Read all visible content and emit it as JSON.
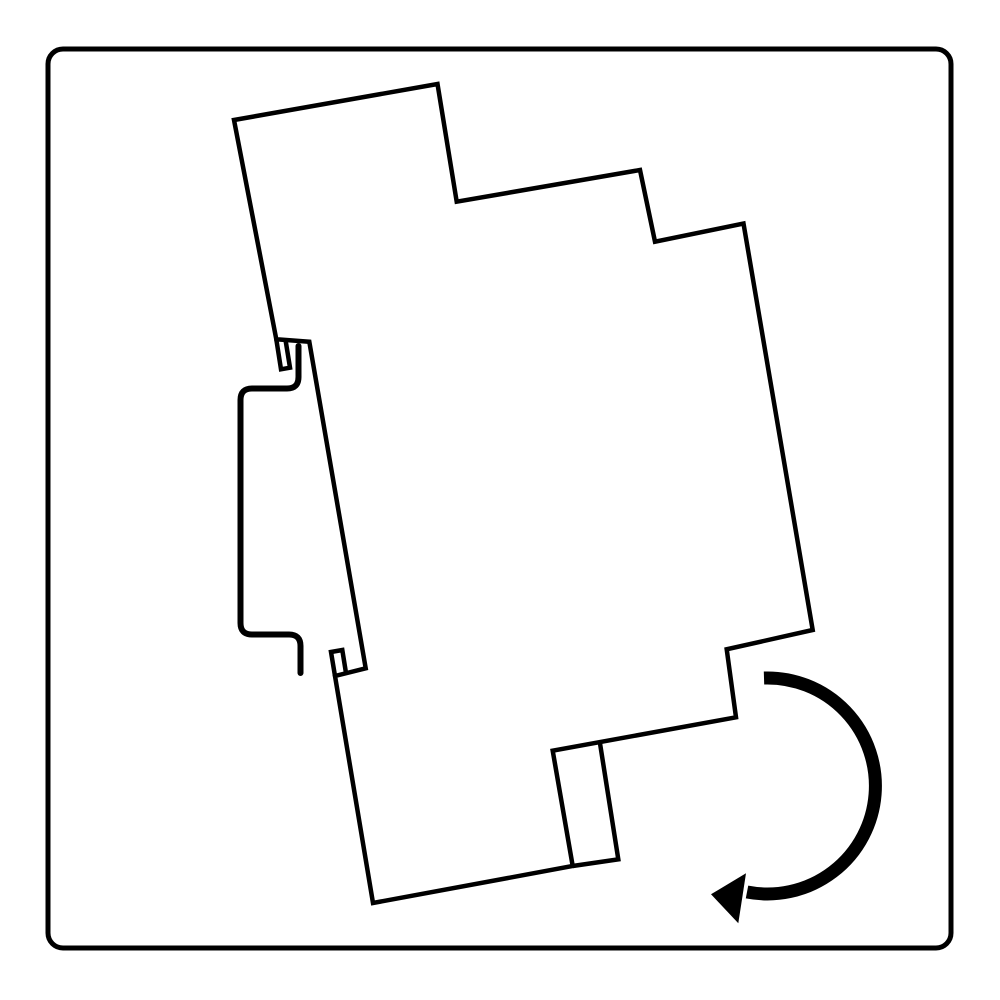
{
  "canvas": {
    "width": 1000,
    "height": 1000,
    "background_color": "#ffffff",
    "line_color": "#000000"
  },
  "frame": {
    "x": 48,
    "y": 49,
    "width": 903,
    "height": 899,
    "corner_radius": 15,
    "stroke_width": 5
  },
  "device_profile": {
    "stroke_width": 4.5,
    "outline_points": [
      [
        234,
        120
      ],
      [
        437.5,
        84
      ],
      [
        456.7,
        201.7
      ],
      [
        640,
        170
      ],
      [
        655,
        241.7
      ],
      [
        743.5,
        223.5
      ],
      [
        812.7,
        630
      ],
      [
        726.7,
        649.3
      ],
      [
        736,
        717.3
      ],
      [
        552.7,
        750.7
      ],
      [
        572.7,
        866
      ],
      [
        373,
        903
      ],
      [
        335,
        676
      ],
      [
        365.7,
        668.3
      ],
      [
        309.3,
        341.7
      ],
      [
        276.3,
        339.3
      ]
    ],
    "top_hook_lip_points": [
      [
        276.3,
        339.3
      ],
      [
        281,
        369.3
      ],
      [
        290,
        367.7
      ],
      [
        285.5,
        339.9
      ]
    ],
    "bottom_lip_points": [
      [
        335,
        676
      ],
      [
        331,
        652
      ],
      [
        342.3,
        650
      ],
      [
        346,
        673
      ]
    ],
    "terminal_tab_points": [
      [
        600,
        743.3
      ],
      [
        618.3,
        859.3
      ],
      [
        572.7,
        866
      ]
    ]
  },
  "din_rail": {
    "stroke_width": 6,
    "path": "M 298.5 346 L 298.5 377 Q 298.5 388.5 287 388.5 L 252 388.5 Q 240.5 388.5 240.5 400 L 240.5 623 Q 240.5 634.5 252 634.5 L 289 634.5 Q 300.5 634.5 300.5 646 L 300.5 673"
  },
  "rotation_arrow": {
    "arc_stroke_width": 13,
    "arc_path": "M 764 678 A 108 108 0 1 1 747 892",
    "head_points": [
      [
        746,
        873.3
      ],
      [
        711,
        894.3
      ],
      [
        738.3,
        923.3
      ]
    ]
  }
}
